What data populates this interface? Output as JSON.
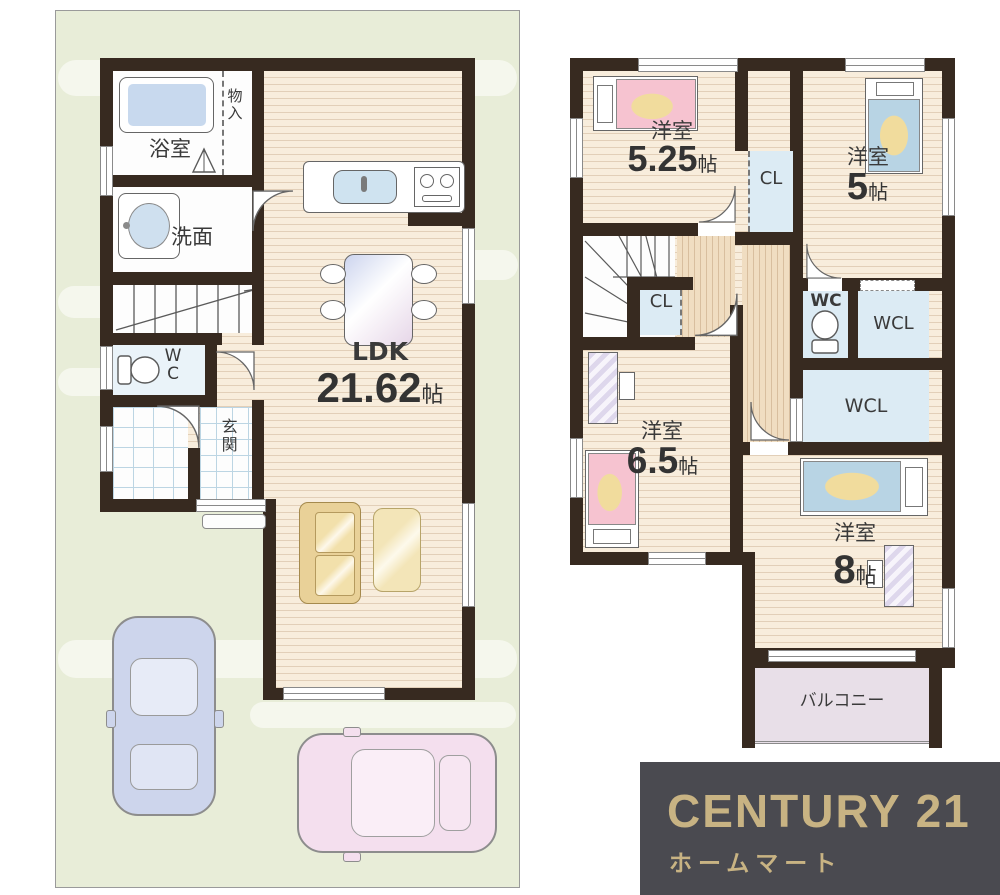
{
  "palette": {
    "wall": "#372a20",
    "floor": "#f8eddc",
    "land": "#e8edd8",
    "room_blue": "#dcebf4",
    "balcony": "#e8dfe8",
    "hall_wood": "#f0ddc1",
    "logo_bg": "#4a4a50",
    "logo_gold": "#c8b383"
  },
  "floor1": {
    "bath": "浴室",
    "storage": "物入",
    "washroom": "洗面",
    "wc": "WC",
    "entrance": "玄関",
    "ldk": "LDK",
    "ldk_size": "21.62",
    "jo": "帖"
  },
  "floor2": {
    "western": "洋室",
    "jo": "帖",
    "sizes": {
      "r525": "5.25",
      "r5": "5",
      "r65": "6.5",
      "r8": "8"
    },
    "cl": "CL",
    "wc": "WC",
    "wcl": "WCL",
    "balcony": "バルコニー"
  },
  "logo": {
    "brand": "CENTURY 21",
    "company": "ホームマート"
  }
}
